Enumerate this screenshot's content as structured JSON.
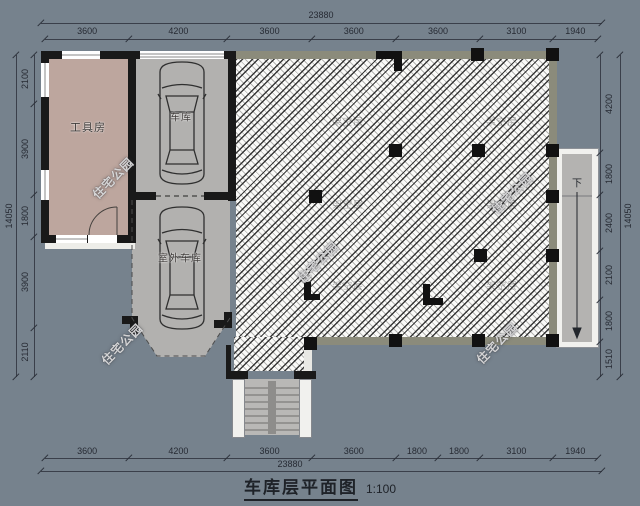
{
  "title": {
    "text": "车库层平面图",
    "scale": "1:100"
  },
  "rooms": {
    "tool_room": "工具房",
    "garage": "车库",
    "outdoor_garage": "室外车库",
    "open_area": "架空层",
    "down": "下"
  },
  "watermark": "住宅公园",
  "dimensions": {
    "top": {
      "total": "23880",
      "segments": [
        "3600",
        "4200",
        "3600",
        "3600",
        "3600",
        "3100",
        "1940"
      ]
    },
    "bottom": {
      "total": "23880",
      "segments": [
        "3600",
        "4200",
        "3600",
        "3600",
        "1800",
        "1800",
        "3100",
        "1940"
      ]
    },
    "left": {
      "total": "14050",
      "segments": [
        "2100",
        "3900",
        "1800",
        "3900",
        "2110"
      ]
    },
    "right": {
      "total": "14050",
      "segments": [
        "4200",
        "1800",
        "2400",
        "2100",
        "1800",
        "1510"
      ]
    }
  },
  "colors": {
    "background": "#76828D",
    "wall": "#191919",
    "tool_room_fill": "#BDA69E",
    "garage_fill": "#B2B1AF",
    "hatch_band": "#8B8B7B",
    "hatch_line": "#262626",
    "dim_text": "#262A33",
    "white_trim": "#F1F1EE"
  }
}
